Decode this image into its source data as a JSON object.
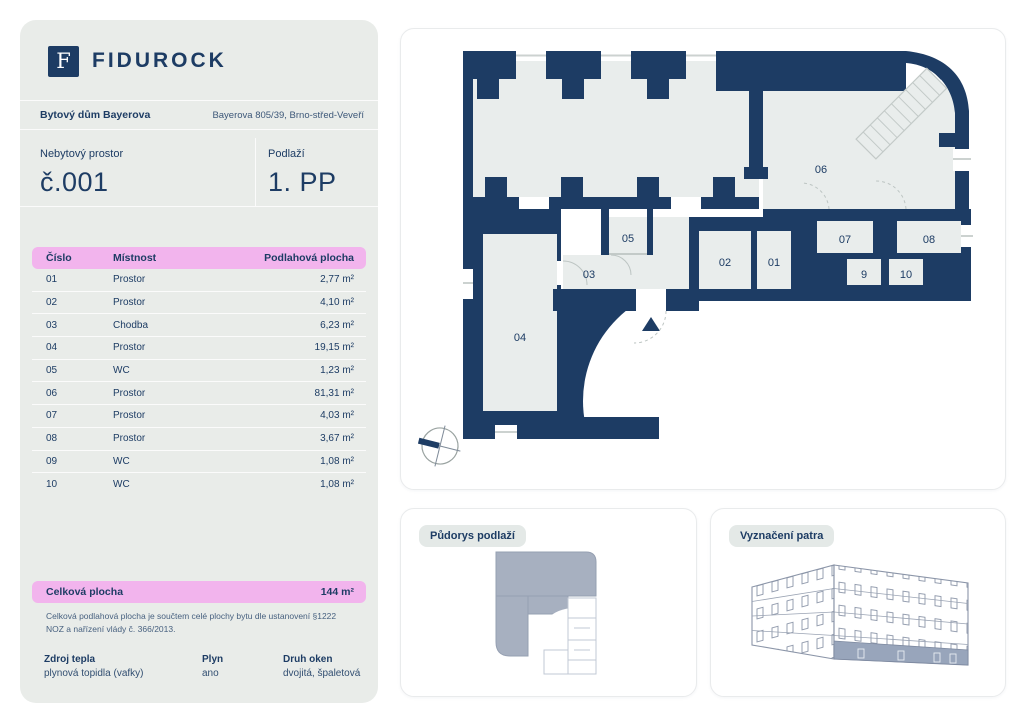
{
  "brand": {
    "name": "FIDUROCK",
    "mark": "F"
  },
  "building": {
    "name": "Bytový dům Bayerova",
    "address": "Bayerova 805/39, Brno-střed-Veveří"
  },
  "unit": {
    "type_label": "Nebytový prostor",
    "number": "č.001",
    "floor_label": "Podlaží",
    "floor": "1. PP"
  },
  "table": {
    "headers": [
      "Číslo",
      "Místnost",
      "Podlahová plocha"
    ],
    "rows": [
      [
        "01",
        "Prostor",
        "2,77 m²"
      ],
      [
        "02",
        "Prostor",
        "4,10 m²"
      ],
      [
        "03",
        "Chodba",
        "6,23 m²"
      ],
      [
        "04",
        "Prostor",
        "19,15 m²"
      ],
      [
        "05",
        "WC",
        "1,23 m²"
      ],
      [
        "06",
        "Prostor",
        "81,31 m²"
      ],
      [
        "07",
        "Prostor",
        "4,03 m²"
      ],
      [
        "08",
        "Prostor",
        "3,67 m²"
      ],
      [
        "09",
        "WC",
        "1,08 m²"
      ],
      [
        "10",
        "WC",
        "1,08 m²"
      ]
    ]
  },
  "total": {
    "label": "Celková plocha",
    "value": "144 m²"
  },
  "note": "Celková podlahová plocha je součtem celé plochy bytu dle ustanovení §1222 NOZ a nařízení vlády č. 366/2013.",
  "details": [
    {
      "label": "Zdroj tepla",
      "value": "plynová topidla (vafky)"
    },
    {
      "label": "Plyn",
      "value": "ano"
    },
    {
      "label": "Druh oken",
      "value": "dvojitá, špaletová"
    }
  ],
  "cards": {
    "floor_plan": "Půdorys podlaží",
    "floor_marking": "Vyznačení patra"
  },
  "plan_labels": {
    "r01": "01",
    "r02": "02",
    "r03": "03",
    "r04": "04",
    "r05": "05",
    "r06": "06",
    "r07": "07",
    "r08": "08",
    "r9": "9",
    "r10": "10"
  },
  "colors": {
    "navy": "#1d3c64",
    "pink": "#f2b4ed",
    "panel": "#e9ece9",
    "room": "#e9edec",
    "slate": "#a7b0c0"
  }
}
